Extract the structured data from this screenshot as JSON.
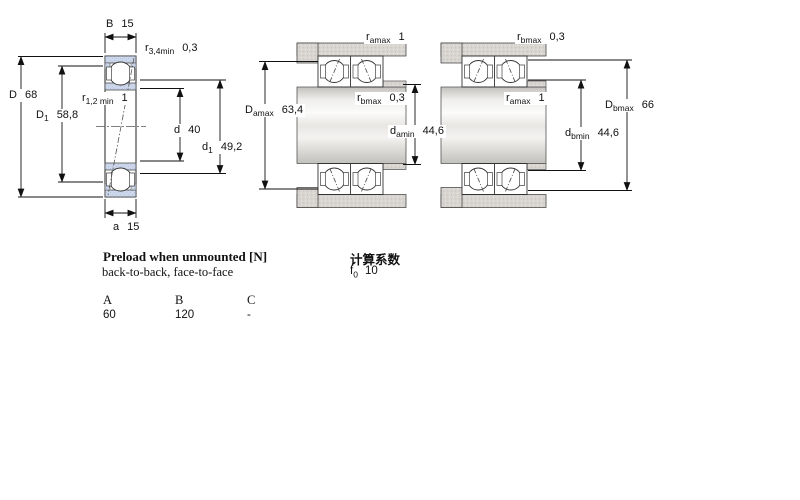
{
  "colors": {
    "line": "#1a1a1a",
    "ring_fill": "#ccd7eb",
    "metal_gray": "#d8d5d1",
    "background": "#ffffff"
  },
  "figures": {
    "fig1": {
      "dims": {
        "B": {
          "sym": "B",
          "sub": "",
          "val": "15"
        },
        "r34": {
          "sym": "r",
          "sub": "3,4min",
          "val": "0,3"
        },
        "D": {
          "sym": "D",
          "sub": "",
          "val": "68"
        },
        "D1": {
          "sym": "D",
          "sub": "1",
          "val": "58,8"
        },
        "r12": {
          "sym": "r",
          "sub": "1,2 min",
          "val": "1"
        },
        "d": {
          "sym": "d",
          "sub": "",
          "val": "40"
        },
        "d1": {
          "sym": "d",
          "sub": "1",
          "val": "49,2"
        },
        "a": {
          "sym": "a",
          "sub": "",
          "val": "15"
        }
      }
    },
    "fig2": {
      "dims": {
        "ramax": {
          "sym": "r",
          "sub": "amax",
          "val": "1"
        },
        "rbmax": {
          "sym": "r",
          "sub": "bmax",
          "val": "0,3"
        },
        "Damax": {
          "sym": "D",
          "sub": "amax",
          "val": "63,4"
        },
        "damin": {
          "sym": "d",
          "sub": "amin",
          "val": "44,6"
        }
      }
    },
    "fig3": {
      "dims": {
        "rbmax": {
          "sym": "r",
          "sub": "bmax",
          "val": "0,3"
        },
        "ramax": {
          "sym": "r",
          "sub": "amax",
          "val": "1"
        },
        "Dbmax": {
          "sym": "D",
          "sub": "bmax",
          "val": "66"
        },
        "dbmin": {
          "sym": "d",
          "sub": "bmin",
          "val": "44,6"
        }
      }
    }
  },
  "notes": {
    "preload_title": "Preload when unmounted [N]",
    "preload_sub": "back-to-back, face-to-face",
    "calc_title": "计算系数",
    "f0_sym": "f",
    "f0_sub": "0",
    "f0_val": "10"
  },
  "preload_table": {
    "headers": [
      "A",
      "B",
      "C"
    ],
    "values": [
      "60",
      "120",
      "-"
    ]
  }
}
